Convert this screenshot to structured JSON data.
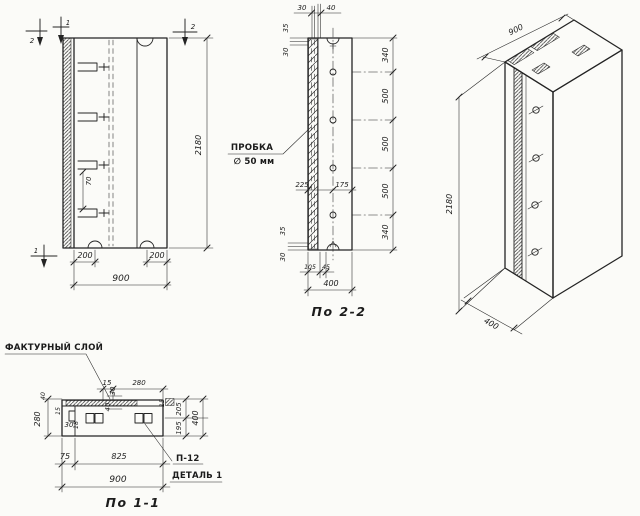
{
  "front_view": {
    "section_marker_top_a": "2",
    "section_marker_top_b": "1",
    "section_marker_top_right": "2",
    "section_marker_bottom": "1",
    "dim_height": "2180",
    "dim_bracket_gap": "70",
    "dim_foot_left": "200",
    "dim_foot_right": "200",
    "dim_width": "900"
  },
  "section22": {
    "title": "По 2-2",
    "plug_label": [
      "ПРОБКА",
      "∅ 50 мм"
    ],
    "dim_top": [
      "30",
      "40"
    ],
    "dim_left_top": [
      "35",
      "30"
    ],
    "dim_left_bottom": [
      "35",
      "30"
    ],
    "dim_mid_left": "225",
    "dim_mid_right": "175",
    "chain": [
      "340",
      "500",
      "500",
      "500",
      "340"
    ],
    "dim_bottom": [
      "105",
      "45"
    ],
    "dim_width": "400"
  },
  "iso": {
    "dim_width": "900",
    "dim_height": "2180",
    "dim_depth": "400"
  },
  "section11": {
    "title": "По 1-1",
    "label_texture_layer": "ФАКТУРНЫЙ СЛОЙ",
    "label_detail_code": "П-12",
    "label_detail_name": "ДЕТАЛЬ 1",
    "dim_top": [
      "15",
      "280"
    ],
    "dim_mid": [
      "30",
      "40"
    ],
    "dim_left": [
      "280",
      "40",
      "15",
      "30",
      "18"
    ],
    "dim_right": [
      "15",
      "205",
      "195",
      "400"
    ],
    "dim_bottom": [
      "75",
      "825",
      "900"
    ]
  }
}
